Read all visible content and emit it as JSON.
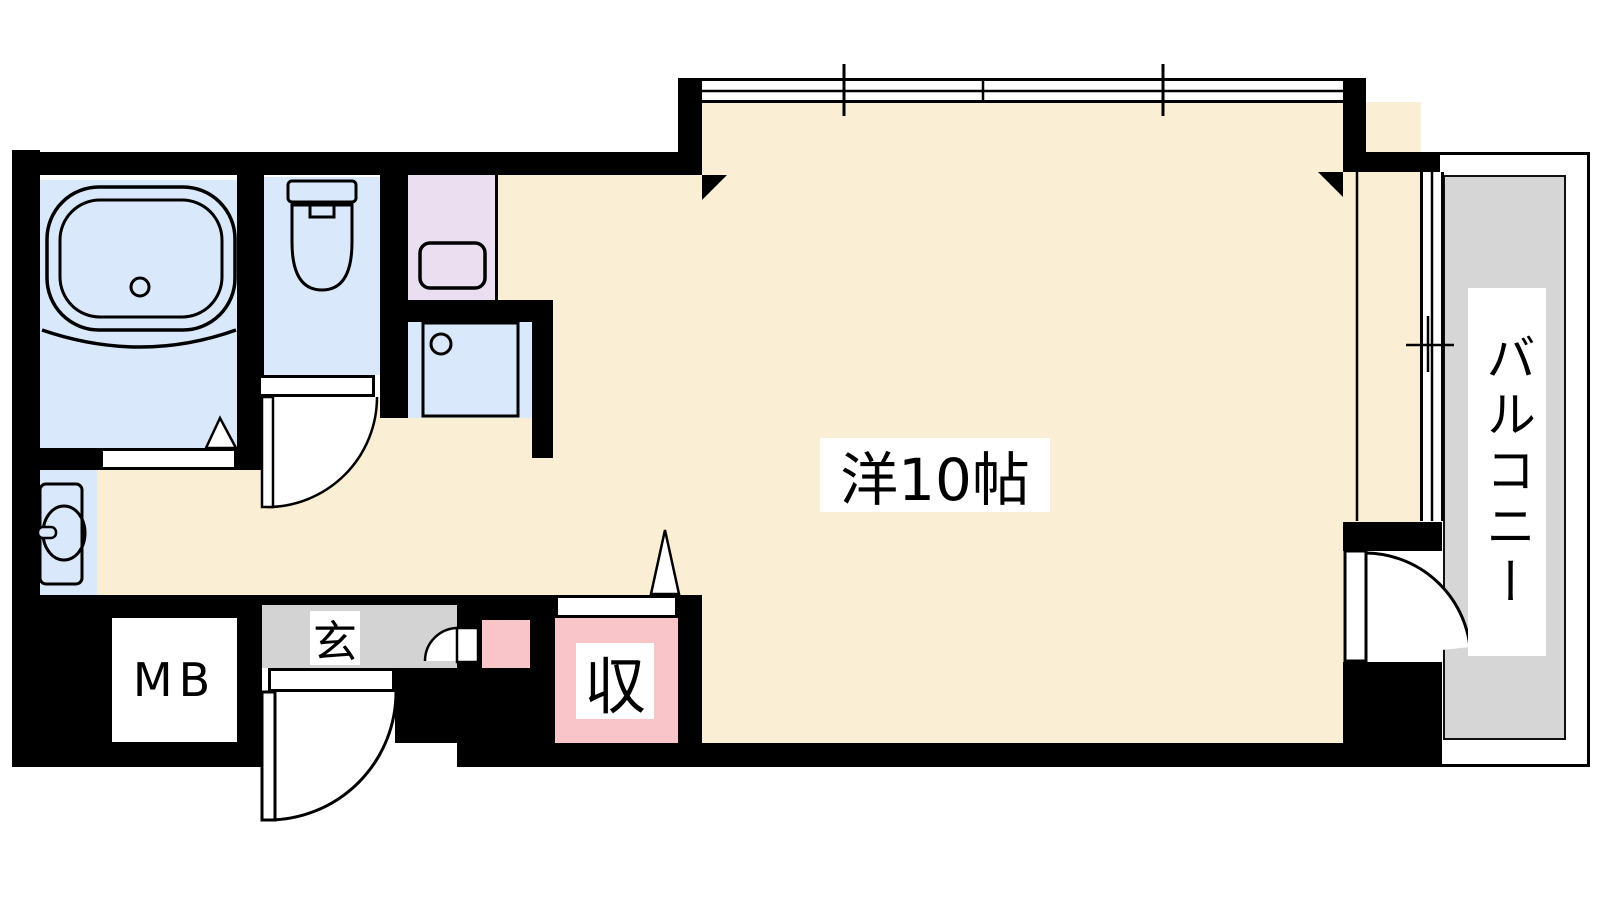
{
  "labels": {
    "main_room": "洋10帖",
    "balcony": "バルコニー",
    "entrance": "玄",
    "storage": "収",
    "meter_box": "MB"
  },
  "colors": {
    "floor_cream": "#FAEFD4",
    "wet_area_blue": "#D9E8FA",
    "kitchen_lavender": "#E9DFF1",
    "storage_pink": "#F9C5C8",
    "entrance_gray": "#D3D3D3",
    "balcony_gray": "#D6D6D6",
    "wall_black": "#000000",
    "background": "#FFFFFF"
  },
  "fixtures": [
    "bathtub-icon",
    "toilet-icon",
    "kitchen-sink-icon",
    "washing-machine-pan-icon",
    "washbasin-icon"
  ]
}
